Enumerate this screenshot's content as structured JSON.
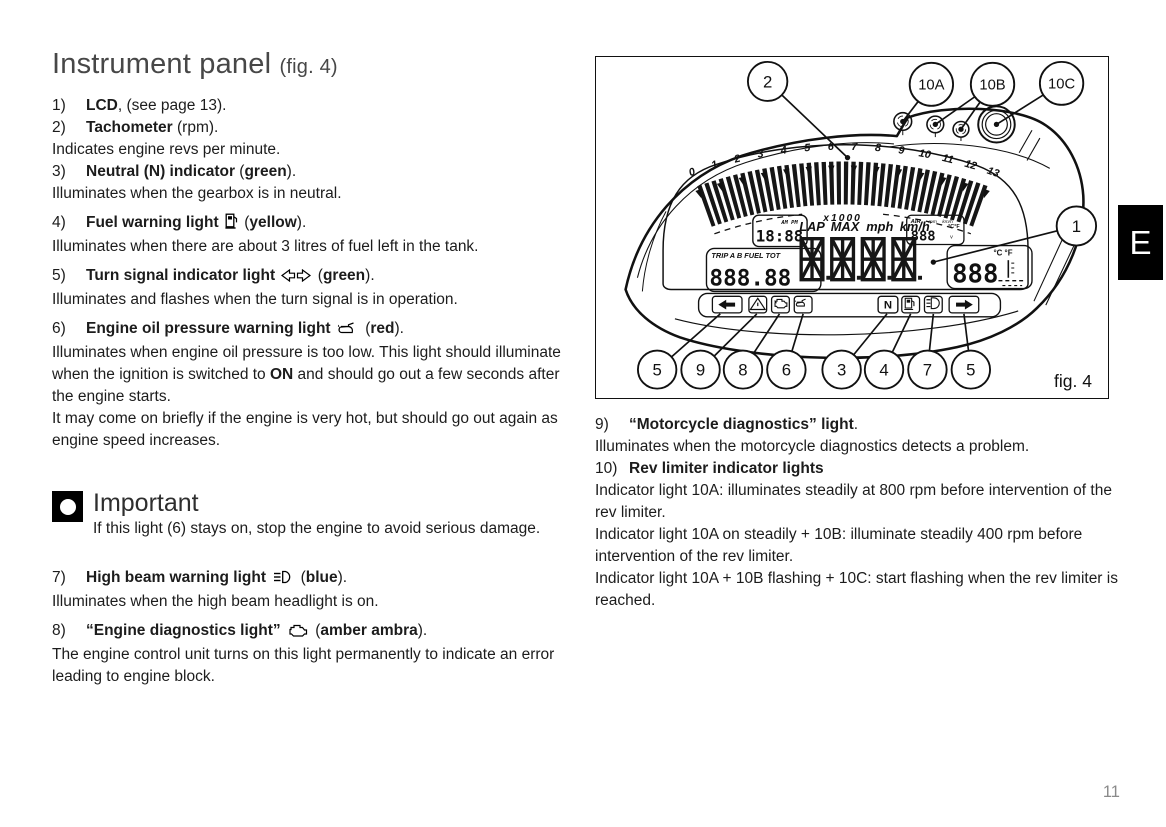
{
  "page": {
    "number": "11",
    "section": "E"
  },
  "doc": {
    "title_main": "Instrument panel",
    "title_fig": "(fig. 4)"
  },
  "left_items": [
    {
      "num": "1)",
      "title": [
        {
          "t": "LCD",
          "b": 1
        },
        {
          "t": ", (see page 13)."
        }
      ],
      "body": []
    },
    {
      "num": "2)",
      "title": [
        {
          "t": "Tachometer",
          "b": 1
        },
        {
          "t": " (rpm)."
        }
      ],
      "body": [
        [
          {
            "t": "Indicates engine revs per minute."
          }
        ]
      ]
    },
    {
      "num": "3)",
      "title": [
        {
          "t": "Neutral (N) indicator",
          "b": 1
        },
        {
          "t": " ("
        },
        {
          "t": "green",
          "b": 1
        },
        {
          "t": ")."
        }
      ],
      "body": [
        [
          {
            "t": "Illuminates when the gearbox is in neutral."
          }
        ]
      ]
    },
    {
      "num": "4)",
      "gap": 1,
      "title": [
        {
          "t": "Fuel warning light",
          "b": 1
        },
        {
          "t": " "
        },
        {
          "icon": "fuel-pump"
        },
        {
          "t": " ("
        },
        {
          "t": "yellow",
          "b": 1
        },
        {
          "t": ")."
        }
      ],
      "body": [
        [
          {
            "t": "Illuminates when there are about 3 litres of fuel left in the tank."
          }
        ]
      ]
    },
    {
      "num": "5)",
      "gap": 1,
      "title": [
        {
          "t": "Turn signal indicator light",
          "b": 1
        },
        {
          "t": " "
        },
        {
          "icon": "turn-signals"
        },
        {
          "t": " ("
        },
        {
          "t": "green",
          "b": 1
        },
        {
          "t": ")."
        }
      ],
      "body": [
        [
          {
            "t": "Illuminates and flashes when the turn signal is in operation."
          }
        ]
      ]
    },
    {
      "num": "6)",
      "gap": 1,
      "title": [
        {
          "t": "Engine oil pressure warning light",
          "b": 1
        },
        {
          "t": " "
        },
        {
          "icon": "oil-pressure"
        },
        {
          "t": " ("
        },
        {
          "t": "red",
          "b": 1
        },
        {
          "t": ")."
        }
      ],
      "body": [
        [
          {
            "t": "Illuminates when engine oil pressure is too low. This light should illuminate when the ignition is switched to "
          },
          {
            "t": "ON",
            "b": 1
          },
          {
            "t": " and should go out a few seconds after the engine starts."
          }
        ],
        [
          {
            "t": "It may come on briefly if the engine is very hot, but should go out again as engine speed increases."
          }
        ]
      ]
    },
    {
      "num": "7)",
      "gap": 1,
      "after_important": 1,
      "title": [
        {
          "t": "High beam warning light",
          "b": 1
        },
        {
          "t": " "
        },
        {
          "icon": "high-beam"
        },
        {
          "t": " ("
        },
        {
          "t": "blue",
          "b": 1
        },
        {
          "t": ")."
        }
      ],
      "body": [
        [
          {
            "t": "Illuminates when the high beam headlight is on."
          }
        ]
      ]
    },
    {
      "num": "8)",
      "gap": 1,
      "title": [
        {
          "t": "“Engine diagnostics light”",
          "b": 1
        },
        {
          "t": " "
        },
        {
          "icon": "engine-diagnostics"
        },
        {
          "t": " ("
        },
        {
          "t": "amber ambra",
          "b": 1
        },
        {
          "t": ")."
        }
      ],
      "body": [
        [
          {
            "t": "The engine control unit turns on this light permanently to indicate an error leading to engine block."
          }
        ]
      ]
    }
  ],
  "important": {
    "heading": "Important",
    "text": "If this light (6) stays on, stop the engine to avoid serious damage."
  },
  "right_items": [
    {
      "num": "9)",
      "title": [
        {
          "t": "“Motorcycle diagnostics” light",
          "b": 1
        },
        {
          "t": "."
        }
      ],
      "body": [
        [
          {
            "t": "Illuminates when the motorcycle diagnostics detects a problem."
          }
        ]
      ]
    },
    {
      "num": "10)",
      "title": [
        {
          "t": "Rev limiter indicator lights",
          "b": 1
        }
      ],
      "body": [
        [
          {
            "t": "Indicator light 10A: illuminates steadily at 800 rpm before intervention of the rev limiter."
          }
        ],
        [
          {
            "t": "Indicator light 10A on steadily + 10B: illuminate steadily 400 rpm before intervention of the rev limiter."
          }
        ],
        [
          {
            "t": "Indicator light 10A + 10B flashing + 10C: start flashing when the rev limiter is reached."
          }
        ]
      ]
    }
  ],
  "figure": {
    "caption": "fig. 4",
    "tach": {
      "labels": [
        "0",
        "1",
        "2",
        "3",
        "4",
        "5",
        "6",
        "7",
        "8",
        "9",
        "10",
        "11",
        "12",
        "13"
      ],
      "multiplier": "x1000"
    },
    "lcd": {
      "clock": "18:88",
      "clock_ampm": "AM PM",
      "trip_labels": "TRIP A B  FUEL  TOT",
      "trip_value": "888.88",
      "main_labels": [
        "LAP",
        "MAX",
        "mph",
        "km/h"
      ],
      "air_label": "AIR",
      "air_sub0": "rpm",
      "air_sub1": "km/h",
      "air_value": "888",
      "air_units": "°C°F",
      "air_v": "v",
      "temp_value": "888",
      "temp_units": "°C °F",
      "neutral": "N"
    },
    "status_icons": [
      "turn-left",
      "warning-triangle",
      "engine-diagnostics",
      "oil-pressure",
      "neutral",
      "fuel-pump",
      "high-beam",
      "turn-right"
    ],
    "callouts": [
      {
        "label": "2",
        "cx": 174,
        "cy": 25,
        "r": 20,
        "fs": 17,
        "dot": 1,
        "targets": [
          [
            255,
            103
          ]
        ]
      },
      {
        "label": "10A",
        "cx": 340,
        "cy": 28,
        "r": 22,
        "fs": 15,
        "dot": 1,
        "targets": [
          [
            311,
            66
          ]
        ]
      },
      {
        "label": "10B",
        "cx": 402,
        "cy": 28,
        "r": 22,
        "fs": 15,
        "dot": 1,
        "targets": [
          [
            344,
            69
          ],
          [
            370,
            74
          ]
        ]
      },
      {
        "label": "10C",
        "cx": 472,
        "cy": 27,
        "r": 22,
        "fs": 15,
        "dot": 1,
        "targets": [
          [
            406,
            69
          ]
        ]
      },
      {
        "label": "1",
        "cx": 487,
        "cy": 173,
        "r": 20,
        "fs": 17,
        "dot": 1,
        "targets": [
          [
            342,
            210
          ]
        ]
      },
      {
        "label": "5",
        "cx": 62,
        "cy": 320,
        "r": 19.5,
        "fs": 17,
        "dot": 0,
        "targets": [
          [
            126,
            263
          ]
        ]
      },
      {
        "label": "9",
        "cx": 106,
        "cy": 320,
        "r": 19.5,
        "fs": 17,
        "dot": 0,
        "targets": [
          [
            163,
            263
          ]
        ]
      },
      {
        "label": "8",
        "cx": 149,
        "cy": 320,
        "r": 19.5,
        "fs": 17,
        "dot": 0,
        "targets": [
          [
            186,
            263
          ]
        ]
      },
      {
        "label": "6",
        "cx": 193,
        "cy": 320,
        "r": 19.5,
        "fs": 17,
        "dot": 0,
        "targets": [
          [
            210,
            263
          ]
        ]
      },
      {
        "label": "3",
        "cx": 249,
        "cy": 320,
        "r": 19.5,
        "fs": 17,
        "dot": 0,
        "targets": [
          [
            295,
            263
          ]
        ]
      },
      {
        "label": "4",
        "cx": 292,
        "cy": 320,
        "r": 19.5,
        "fs": 17,
        "dot": 0,
        "targets": [
          [
            319,
            263
          ]
        ]
      },
      {
        "label": "7",
        "cx": 336,
        "cy": 320,
        "r": 19.5,
        "fs": 17,
        "dot": 0,
        "targets": [
          [
            342,
            263
          ]
        ]
      },
      {
        "label": "5",
        "cx": 380,
        "cy": 320,
        "r": 19.5,
        "fs": 17,
        "dot": 0,
        "targets": [
          [
            373,
            263
          ]
        ]
      }
    ]
  }
}
